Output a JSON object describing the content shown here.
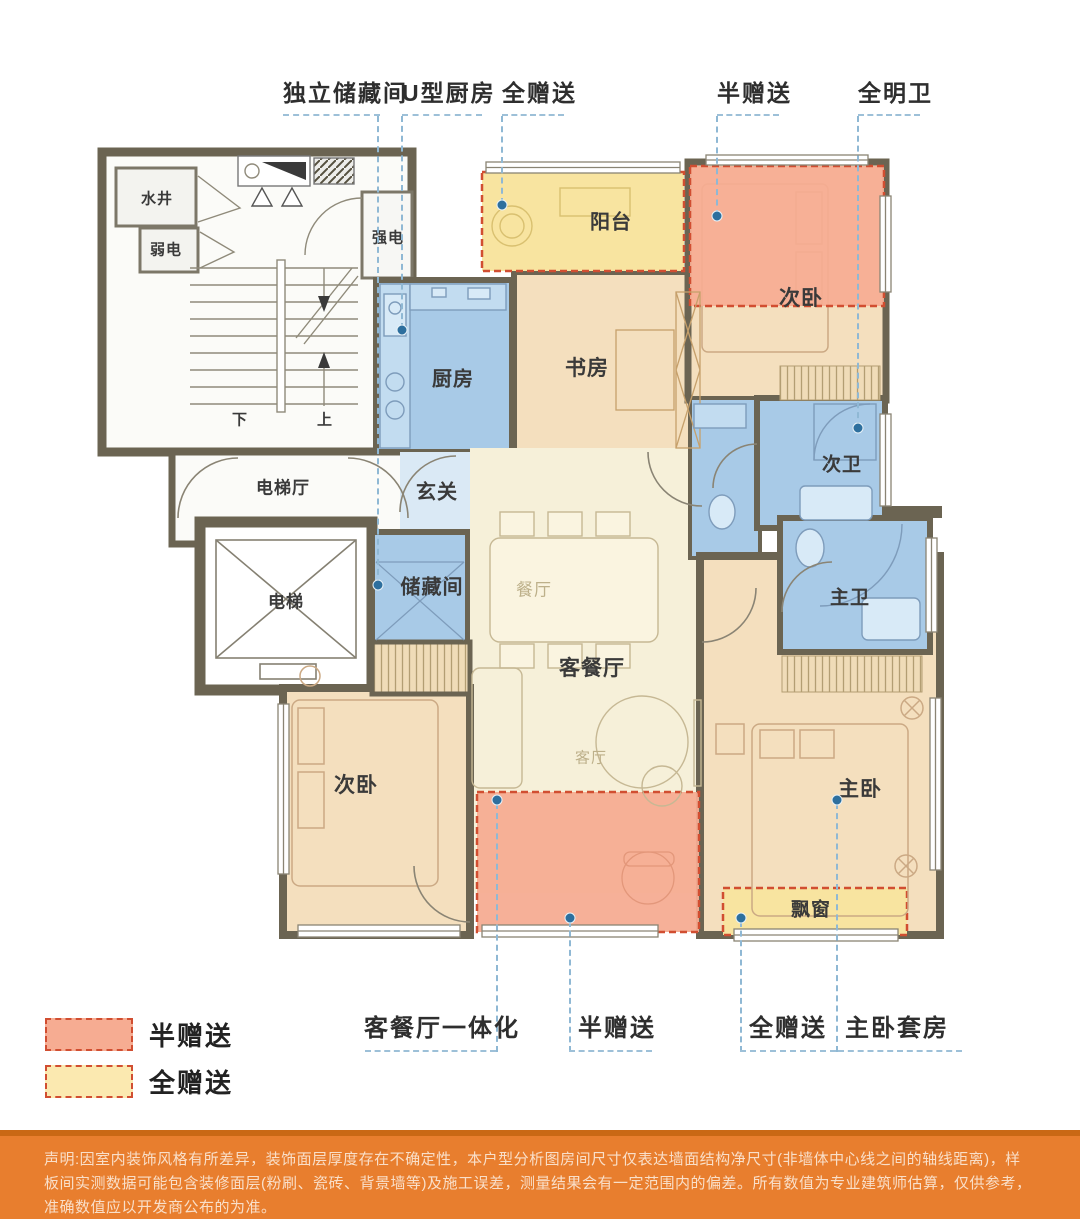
{
  "colors": {
    "half_gift_pink": "#F6AC92",
    "full_gift_yellow": "#F8E4A0",
    "wet_room_blue": "#A8CAE7",
    "hall_blue": "#DAE9F5",
    "bedroom_tan": "#F4DFBE",
    "living_cream": "#F6F0D9",
    "wall": "#6B6452",
    "red_dashed_border": "#D14E31",
    "callout_line_blue": "#8FB8D4",
    "callout_dot_blue": "#2D6F9E",
    "footer_orange": "#E87E2E"
  },
  "callouts_top": [
    {
      "label": "独立储藏间"
    },
    {
      "label": "U型厨房"
    },
    {
      "label": "全赠送"
    },
    {
      "label": "半赠送"
    },
    {
      "label": "全明卫"
    }
  ],
  "callouts_bottom": [
    {
      "label": "客餐厅一体化"
    },
    {
      "label": "半赠送"
    },
    {
      "label": "全赠送"
    },
    {
      "label": "主卧套房"
    }
  ],
  "rooms": {
    "water_well": "水井",
    "weak_power": "弱电",
    "strong_power": "强电",
    "stairs_down": "下",
    "stairs_up": "上",
    "elevator_hall": "电梯厅",
    "elevator": "电梯",
    "kitchen": "厨房",
    "foyer": "玄关",
    "storage": "储藏间",
    "dining": "餐厅",
    "living_dining": "客餐厅",
    "living": "客厅",
    "study": "书房",
    "balcony": "阳台",
    "bedroom2": "次卧",
    "bath2": "次卫",
    "master_bath": "主卫",
    "master_bedroom": "主卧",
    "bedroom3": "次卧",
    "bay_window": "飘窗"
  },
  "legend": [
    {
      "label": "半赠送",
      "color": "#F6AC92"
    },
    {
      "label": "全赠送",
      "color": "#FBE9B0"
    }
  ],
  "footer": {
    "disclaimer": "声明:因室内装饰风格有所差异，装饰面层厚度存在不确定性，本户型分析图房间尺寸仅表达墙面结构净尺寸(非墙体中心线之间的轴线距离)，样板间实测数据可能包含装修面层(粉刷、瓷砖、背景墙等)及施工误差，测量结果会有一定范围内的偏差。所有数值为专业建筑师估算，仅供参考，准确数值应以开发商公布的为准。"
  }
}
